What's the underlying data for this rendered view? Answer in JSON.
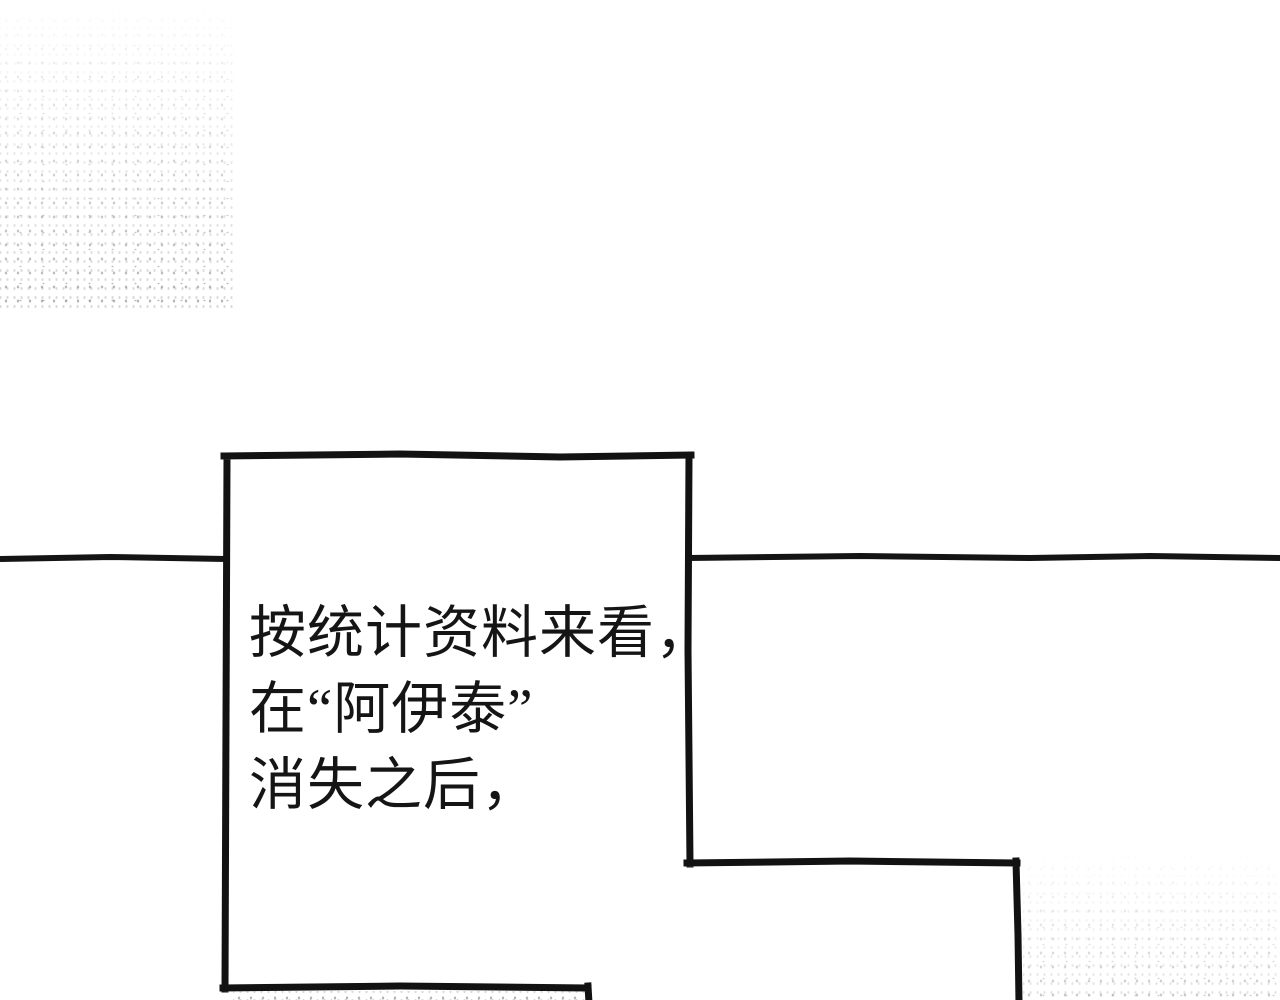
{
  "page": {
    "background_color": "#ffffff",
    "ink_color": "#151515"
  },
  "speech_panel": {
    "lines": [
      "按统计资料来看，",
      "在“阿伊泰”",
      "消失之后，"
    ]
  }
}
